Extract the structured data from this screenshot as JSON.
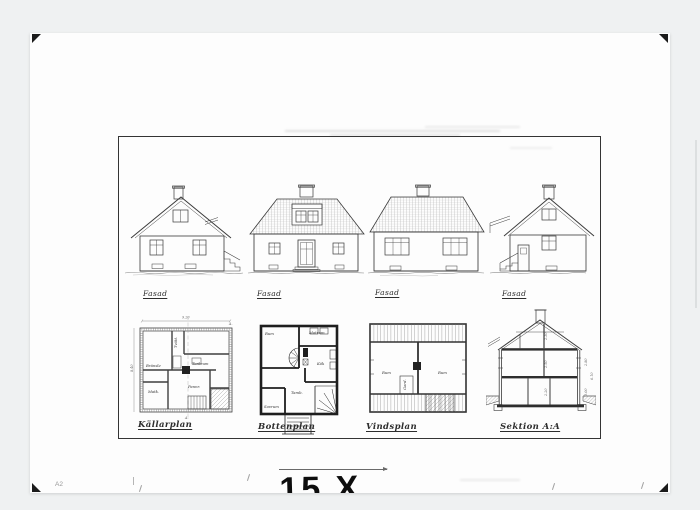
{
  "sheet": {
    "code": "A2",
    "plate_number": "15 X"
  },
  "figures": {
    "elevations": [
      {
        "caption": "Fasad"
      },
      {
        "caption": "Fasad"
      },
      {
        "caption": "Fasad"
      },
      {
        "caption": "Fasad"
      }
    ],
    "plans": {
      "kallarplan": {
        "caption": "Källarplan",
        "rooms": {
          "bransle": "Bränsle",
          "matk": "Matk.",
          "tvatt": "Tvätt.",
          "torkrum": "Torkrum",
          "pannrum": "Pannr."
        },
        "dims": {
          "width": "9.20",
          "depth": "8.40",
          "section_mark_top": "A.",
          "section_mark_bottom": "A."
        }
      },
      "bottenplan": {
        "caption": "Bottenplan",
        "rooms": {
          "rum": "Rum",
          "matrum": "Matrum",
          "kok": "Kök",
          "tamb": "Tamb.",
          "sovrum": "Sovrum"
        }
      },
      "vindsplan": {
        "caption": "Vindsplan",
        "rooms": {
          "rum_left": "Rum",
          "rum_right": "Rum",
          "gard": "Gard."
        }
      },
      "sektion": {
        "caption": "Sektion A:A",
        "dims": {
          "attic": "2.30",
          "ground": "2.50",
          "basement": "2.20",
          "right_upper": "2.80",
          "right_lower": "3.00",
          "total": "6.10"
        }
      }
    }
  },
  "colors": {
    "ink": "#3a3a3a",
    "paper": "#fdfdfd",
    "background": "#eff1f2"
  }
}
